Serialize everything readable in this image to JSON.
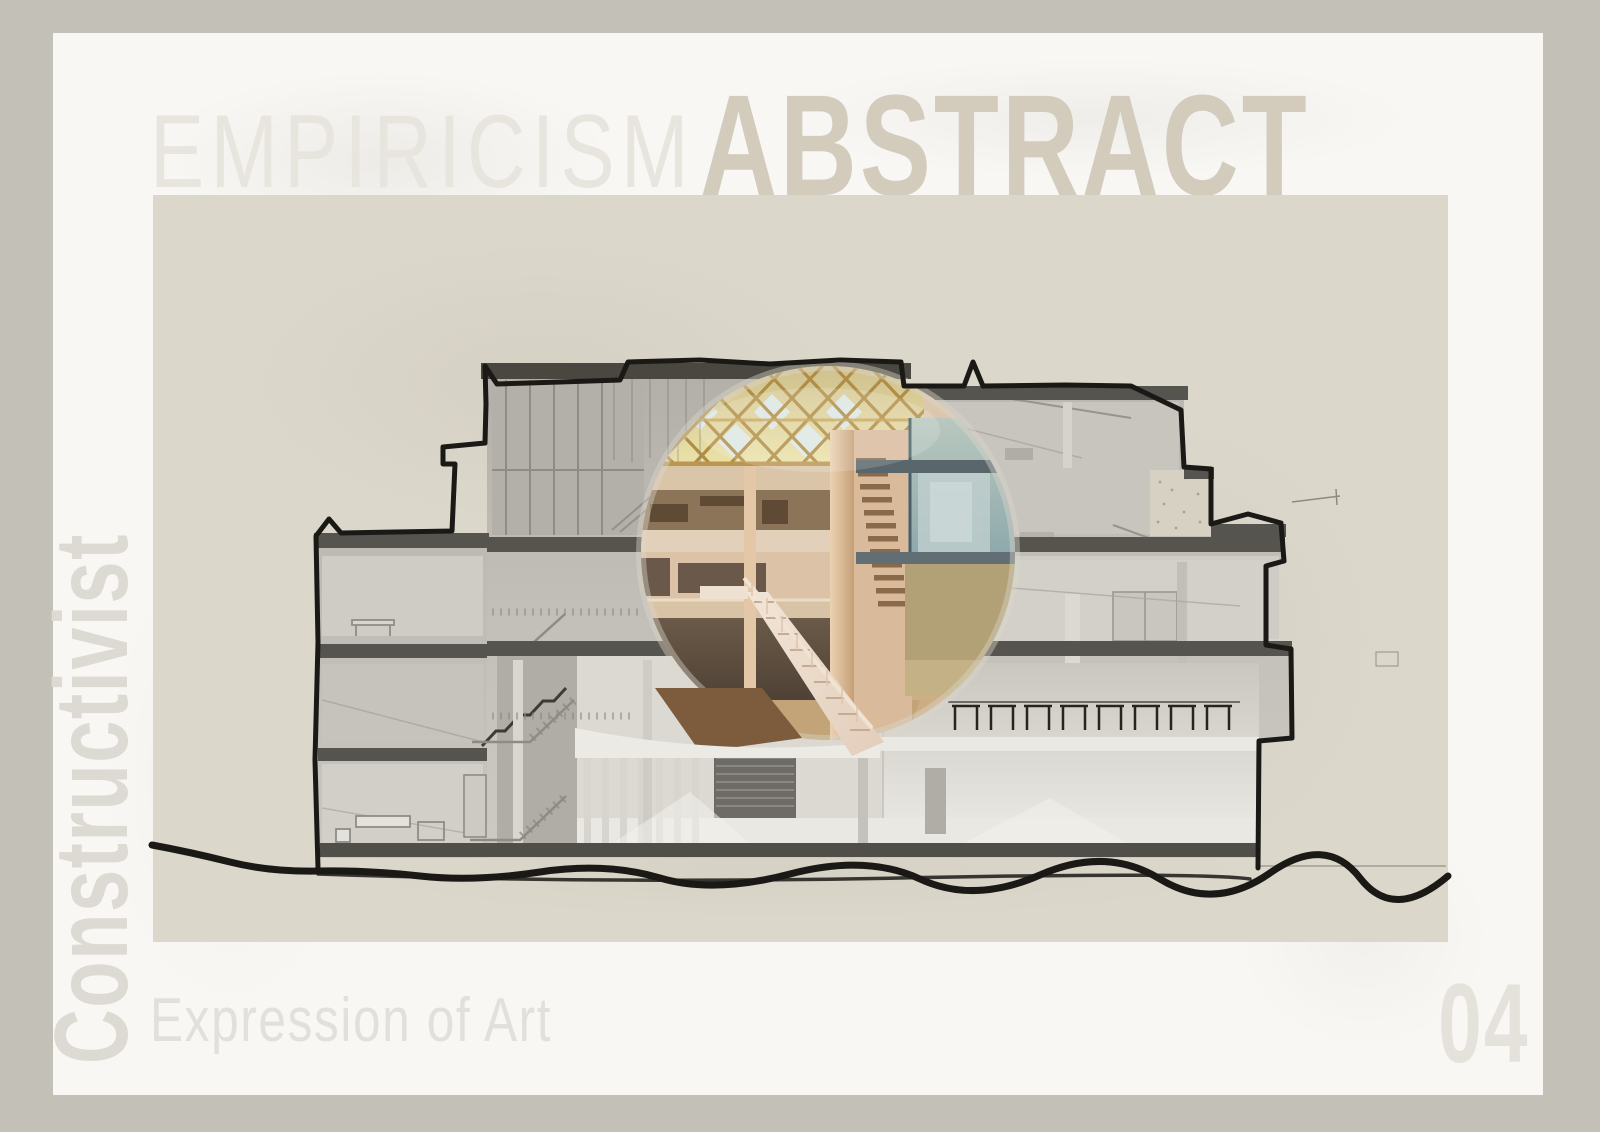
{
  "page": {
    "header": {
      "word_light": "EMPIRICISM",
      "word_bold": "ABSTRACT"
    },
    "side": {
      "vertical_word": "Constructivist"
    },
    "footer": {
      "subtitle": "Expression of Art",
      "page_number": "04"
    },
    "artwork": {
      "subject": "Sectional perspective of a multi-storey building, grayscale with a circular colour-highlighted atrium"
    },
    "colors": {
      "frame": "#c2c0b7",
      "paper": "#f8f7f4",
      "canvas": "#dbd7cb",
      "ink": "#1b1915",
      "word_light": "#e8e5df",
      "word_bold": "#d3ccbd",
      "word_vertical": "#dcdad3",
      "word_subtitle": "#e2e0db",
      "word_number": "#e4e2da",
      "accent_gold": "#c2a050",
      "accent_blue": "#7fa2ab",
      "accent_warm": "#ddbf9f"
    }
  }
}
